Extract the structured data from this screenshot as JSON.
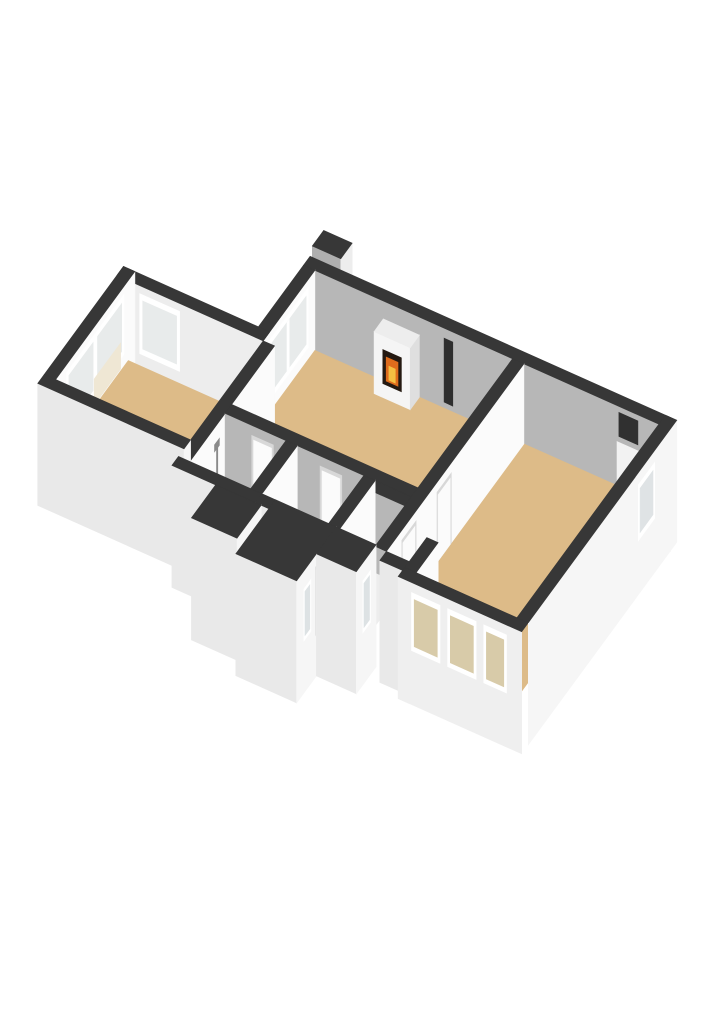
{
  "meta": {
    "image_type": "3d-floorplan-render",
    "background": "#FFFFFF",
    "view": "isometric-cutaway"
  },
  "palette": {
    "wall_top": "#373737",
    "wall_white_face": "#FBFBFB",
    "wall_gray_face": "#B7B7B7",
    "wall_ext_light": "#E9E9E9",
    "wall_ext_white": "#F6F6F6",
    "floor_tan": "#DDBB88",
    "floor_gold": "#D2A35C",
    "floor_blue": "#D4DFE8",
    "glass": "#E8EBEB",
    "glass_ext": "#D8CBA9",
    "frame_white": "#FFFFFF",
    "radiator_cream": "#EFE7D4",
    "firebox_dark": "#241911",
    "flame_orange": "#DF6C1C",
    "flame_yellow": "#F5BF42"
  },
  "rooms": [
    {
      "id": "bedroom-left",
      "floor": "#DDBB88"
    },
    {
      "id": "living-room",
      "floor": "#DDBB88"
    },
    {
      "id": "bedroom-right",
      "floor": "#DDBB88"
    },
    {
      "id": "bathroom",
      "floor": "#D4DFE8"
    },
    {
      "id": "hallway",
      "floor": "#D2A35C"
    },
    {
      "id": "utility-room",
      "floor": "#EDEDED"
    },
    {
      "id": "balcony",
      "floor": "#D4DFE8"
    },
    {
      "id": "window-bay",
      "floor": "#DDBB88"
    }
  ],
  "scene": {
    "projection": {
      "ox": 180,
      "oy": 290,
      "ax": 38,
      "ay": 17,
      "bx": -22,
      "by": 30
    },
    "wall_height": 80,
    "elements": [
      {
        "name": "chimney",
        "kind": "box",
        "x1": 3.55,
        "y1": -0.4,
        "x2": 4.3,
        "y2": 0.12,
        "h": 108,
        "b": -42,
        "fills": {
          "top": "#373737",
          "x": "#EDEDED",
          "y": "#AFAFAF"
        }
      },
      {
        "name": "facade-top-wall",
        "kind": "box",
        "x1": 3.25,
        "y1": -0.3,
        "x2": 12.9,
        "y2": 0,
        "h": 80,
        "b": -42,
        "fills": {
          "top": "#373737",
          "y": "#B7B7B7"
        }
      },
      {
        "name": "vent-niche",
        "kind": "decaly",
        "y": 0,
        "u1": 6.95,
        "u2": 7.18,
        "z1": 6,
        "z2": 70,
        "fill": "#2E2E2E"
      },
      {
        "name": "radiator-right",
        "kind": "decaly",
        "y": 0,
        "u1": 11.5,
        "u2": 12.1,
        "z1": 2,
        "z2": 44,
        "fill": "#F2F2F2"
      },
      {
        "name": "niche-right",
        "kind": "decaly",
        "y": 0,
        "u1": 11.55,
        "u2": 12.05,
        "z1": 50,
        "z2": 74,
        "fill": "#303030"
      },
      {
        "name": "living-window-wall",
        "kind": "box",
        "x1": 3.25,
        "y1": 0,
        "x2": 3.55,
        "y2": 2.35,
        "h": 80,
        "b": -42,
        "fills": {
          "top": "#373737",
          "x": "#FBFBFB",
          "y": "#E9E9E9"
        }
      },
      {
        "name": "living-window-frame",
        "kind": "decalx",
        "x": 3.55,
        "u1": 0.3,
        "u2": 2.15,
        "z1": 12,
        "z2": 72,
        "fill": "#FFFFFF"
      },
      {
        "name": "living-window-glass",
        "kind": "decalx",
        "x": 3.55,
        "u1": 0.4,
        "u2": 2.05,
        "z1": 18,
        "z2": 66,
        "fill": "#E8EBEB"
      },
      {
        "name": "living-window-mullion",
        "kind": "decalx",
        "x": 3.55,
        "u1": 1.17,
        "u2": 1.27,
        "z1": 18,
        "z2": 66,
        "fill": "#FFFFFF"
      },
      {
        "name": "bedroom-top-wall",
        "kind": "box",
        "x1": -0.3,
        "y1": 2.05,
        "x2": 3.55,
        "y2": 2.35,
        "h": 80,
        "b": -42,
        "fills": {
          "top": "#373737",
          "y": "#EDEDED"
        }
      },
      {
        "name": "bedroom-corner-window-frame",
        "kind": "decaly",
        "y": 2.35,
        "u1": 0.3,
        "u2": 1.35,
        "z1": 12,
        "z2": 72,
        "fill": "#FFFFFF"
      },
      {
        "name": "bedroom-corner-window-glass",
        "kind": "decaly",
        "y": 2.35,
        "u1": 0.38,
        "u2": 1.27,
        "z1": 18,
        "z2": 66,
        "fill": "#E8EBEB"
      },
      {
        "name": "bedroom-window-wall",
        "kind": "box",
        "x1": -0.3,
        "y1": 2.05,
        "x2": 0,
        "y2": 5.65,
        "h": 80,
        "b": -42,
        "fills": {
          "top": "#373737",
          "x": "#FBFBFB"
        }
      },
      {
        "name": "bedroom-window-frame",
        "kind": "decalx",
        "x": 0,
        "u1": 2.55,
        "u2": 5.15,
        "z1": 12,
        "z2": 72,
        "fill": "#FFFFFF"
      },
      {
        "name": "bedroom-window-glass-1",
        "kind": "decalx",
        "x": 0,
        "u1": 2.65,
        "u2": 3.75,
        "z1": 18,
        "z2": 66,
        "fill": "#E8EBEB"
      },
      {
        "name": "bedroom-window-glass-2",
        "kind": "decalx",
        "x": 0,
        "u1": 3.95,
        "u2": 5.05,
        "z1": 18,
        "z2": 66,
        "fill": "#E8EBEB"
      },
      {
        "name": "bedroom-radiator-panel",
        "kind": "decalx",
        "x": 0,
        "u1": 2.7,
        "u2": 3.9,
        "z1": 2,
        "z2": 28,
        "fill": "#EFE7D4"
      },
      {
        "name": "living-room-floor",
        "kind": "floor",
        "pts": [
          [
            3.55,
            0
          ],
          [
            8.75,
            0
          ],
          [
            8.75,
            4.3
          ],
          [
            3.55,
            4.3
          ]
        ],
        "fill": "#DDBB88"
      },
      {
        "name": "bedroom-left-floor",
        "kind": "floor",
        "pts": [
          [
            0,
            2.35
          ],
          [
            3.55,
            2.35
          ],
          [
            3.55,
            5.65
          ],
          [
            0,
            5.65
          ]
        ],
        "fill": "#DDBB88"
      },
      {
        "name": "bedroom-right-floor",
        "kind": "floor",
        "pts": [
          [
            9.05,
            0
          ],
          [
            12.6,
            0
          ],
          [
            12.6,
            5.45
          ],
          [
            9.05,
            5.45
          ]
        ],
        "fill": "#DDBB88"
      },
      {
        "name": "bay-floor",
        "kind": "floor",
        "pts": [
          [
            9.95,
            5.45
          ],
          [
            12.6,
            5.45
          ],
          [
            12.6,
            6.45
          ],
          [
            9.95,
            6.45
          ]
        ],
        "fill": "#DDBB88"
      },
      {
        "name": "balcony-threshold",
        "kind": "floor",
        "pts": [
          [
            9.05,
            5.3
          ],
          [
            9.65,
            5.3
          ],
          [
            9.65,
            5.45
          ],
          [
            9.05,
            5.45
          ]
        ],
        "fill": "#F0F0F0"
      },
      {
        "name": "balcony-floor",
        "kind": "floor",
        "pts": [
          [
            9.05,
            5.45
          ],
          [
            9.65,
            5.45
          ],
          [
            9.65,
            6.25
          ],
          [
            9.05,
            6.25
          ]
        ],
        "fill": "#D4DFE8"
      },
      {
        "name": "bathroom-floor",
        "kind": "floor",
        "pts": [
          [
            3.85,
            4.6
          ],
          [
            5.45,
            4.6
          ],
          [
            5.45,
            6.2
          ],
          [
            3.85,
            6.2
          ]
        ],
        "fill": "#D4DFE8"
      },
      {
        "name": "hallway-floor",
        "kind": "floor",
        "pts": [
          [
            5.75,
            4.6
          ],
          [
            7.5,
            4.6
          ],
          [
            7.5,
            6.2
          ],
          [
            5.75,
            6.2
          ]
        ],
        "fill": "#D2A35C"
      },
      {
        "name": "utility-floor",
        "kind": "floor",
        "pts": [
          [
            7.8,
            4.9
          ],
          [
            8.75,
            4.9
          ],
          [
            8.75,
            6.2
          ],
          [
            7.8,
            6.2
          ]
        ],
        "fill": "#EDEDED"
      },
      {
        "name": "fireplace-surround",
        "kind": "box",
        "x1": 5.35,
        "y1": 0,
        "x2": 6.3,
        "y2": 0.42,
        "h": 62,
        "b": 0,
        "fills": {
          "top": "#EDEDED",
          "x": "#DFDFDF",
          "y": "#F5F5F5"
        }
      },
      {
        "name": "fireplace-firebox",
        "kind": "decaly",
        "y": 0.42,
        "u1": 5.58,
        "u2": 6.07,
        "z1": 14,
        "z2": 48,
        "fill": "#241911"
      },
      {
        "name": "fireplace-flame",
        "kind": "decaly",
        "y": 0.42,
        "u1": 5.67,
        "u2": 5.98,
        "z1": 18,
        "z2": 42,
        "fill": "#DF6C1C"
      },
      {
        "name": "fireplace-flame-core",
        "kind": "decaly",
        "y": 0.42,
        "u1": 5.74,
        "u2": 5.91,
        "z1": 20,
        "z2": 34,
        "fill": "#F5BF42"
      },
      {
        "name": "bedroom-bathroom-divider",
        "kind": "box",
        "x1": 3.55,
        "y1": 2.35,
        "x2": 3.85,
        "y2": 6.5,
        "h": 80,
        "b": 0,
        "fills": {
          "top": "#373737",
          "x": "#FBFBFB"
        }
      },
      {
        "name": "shower-pole",
        "kind": "decalx",
        "x": 3.85,
        "u1": 4.93,
        "u2": 4.99,
        "z1": 28,
        "z2": 58,
        "fill": "#8A8A8A"
      },
      {
        "name": "shower-head",
        "kind": "decalx",
        "x": 3.85,
        "u1": 4.86,
        "u2": 5.08,
        "z1": 56,
        "z2": 63,
        "fill": "#8A8A8A"
      },
      {
        "name": "toilet-tank",
        "kind": "box",
        "x1": 3.9,
        "y1": 5.78,
        "x2": 4.2,
        "y2": 5.96,
        "h": 30,
        "b": 0,
        "fills": {
          "top": "#F0F0F0",
          "x": "#E6E6E6",
          "y": "#FAFAFA"
        }
      },
      {
        "name": "toilet-bowl",
        "kind": "box",
        "x1": 3.93,
        "y1": 5.48,
        "x2": 4.17,
        "y2": 5.8,
        "h": 16,
        "b": 0,
        "fills": {
          "top": "#FFFFFF",
          "x": "#E8E8E8",
          "y": "#F6F6F6"
        }
      },
      {
        "name": "living-bottom-wall",
        "kind": "box",
        "x1": 3.85,
        "y1": 4.3,
        "x2": 8.75,
        "y2": 4.6,
        "h": 80,
        "b": 0,
        "fills": {
          "top": "#373737",
          "y": "#B7B7B7"
        }
      },
      {
        "name": "bathroom-door-frame",
        "kind": "decaly",
        "y": 4.6,
        "u1": 4.55,
        "u2": 5.12,
        "z1": 0,
        "z2": 70,
        "fill": "#D8D8D8"
      },
      {
        "name": "bathroom-door",
        "kind": "decaly",
        "y": 4.6,
        "u1": 4.6,
        "u2": 5.07,
        "z1": 0,
        "z2": 66,
        "fill": "#FBFBFB"
      },
      {
        "name": "living-door-frame",
        "kind": "decaly",
        "y": 4.6,
        "u1": 6.35,
        "u2": 6.92,
        "z1": 0,
        "z2": 70,
        "fill": "#D8D8D8"
      },
      {
        "name": "living-door",
        "kind": "decaly",
        "y": 4.6,
        "u1": 6.4,
        "u2": 6.87,
        "z1": 0,
        "z2": 66,
        "fill": "#FBFBFB"
      },
      {
        "name": "hall-bathroom-divider",
        "kind": "box",
        "x1": 5.45,
        "y1": 4.6,
        "x2": 5.75,
        "y2": 6.5,
        "h": 80,
        "b": 0,
        "fills": {
          "top": "#373737",
          "x": "#FBFBFB"
        }
      },
      {
        "name": "utility-top-wall",
        "kind": "box",
        "x1": 7.8,
        "y1": 4.6,
        "x2": 8.75,
        "y2": 4.9,
        "h": 80,
        "b": 0,
        "fills": {
          "top": "#373737",
          "y": "#B7B7B7"
        }
      },
      {
        "name": "hall-utility-divider",
        "kind": "box",
        "x1": 7.5,
        "y1": 4.6,
        "x2": 7.8,
        "y2": 6.5,
        "h": 80,
        "b": 0,
        "fills": {
          "top": "#373737",
          "x": "#FBFBFB"
        }
      },
      {
        "name": "utility-appliance",
        "kind": "box",
        "x1": 8.0,
        "y1": 5.85,
        "x2": 8.3,
        "y2": 6.18,
        "h": 26,
        "b": 0,
        "fills": {
          "top": "#3E3E3E",
          "x": "#E9E9E9",
          "y": "#F4F4F4"
        }
      },
      {
        "name": "living-right-divider",
        "kind": "box",
        "x1": 8.75,
        "y1": 0,
        "x2": 9.05,
        "y2": 6.25,
        "h": 80,
        "b": 0,
        "fills": {
          "top": "#373737",
          "x": "#FBFBFB"
        }
      },
      {
        "name": "right-door-frame-1",
        "kind": "decalx",
        "x": 9.05,
        "u1": 3.3,
        "u2": 3.95,
        "z1": 0,
        "z2": 70,
        "fill": "#D8D8D8"
      },
      {
        "name": "right-door-1",
        "kind": "decalx",
        "x": 9.05,
        "u1": 3.35,
        "u2": 3.9,
        "z1": 0,
        "z2": 66,
        "fill": "#FBFBFB"
      },
      {
        "name": "right-door-frame-2",
        "kind": "decalx",
        "x": 9.05,
        "u1": 4.9,
        "u2": 5.55,
        "z1": 0,
        "z2": 70,
        "fill": "#D8D8D8"
      },
      {
        "name": "right-door-2",
        "kind": "decalx",
        "x": 9.05,
        "u1": 4.95,
        "u2": 5.5,
        "z1": 0,
        "z2": 66,
        "fill": "#FBFBFB"
      },
      {
        "name": "bedroom-bottom-wall",
        "kind": "box",
        "x1": -0.3,
        "y1": 5.65,
        "x2": 3.55,
        "y2": 5.95,
        "h": 80,
        "b": -42,
        "fills": {
          "top": "#373737",
          "y": "#E9E9E9",
          "x": "#F6F6F6"
        }
      },
      {
        "name": "bathroom-bottom-wall",
        "kind": "box",
        "x1": 3.55,
        "y1": 6.2,
        "x2": 5.75,
        "y2": 6.5,
        "h": 80,
        "b": -42,
        "fills": {
          "top": "#373737",
          "y": "#E9E9E9",
          "x": "#F6F6F6"
        }
      },
      {
        "name": "hall-bottom-wall",
        "kind": "box",
        "x1": 5.75,
        "y1": 6.2,
        "x2": 6.1,
        "y2": 6.5,
        "h": 80,
        "b": -42,
        "fills": {
          "top": "#373737",
          "y": "#E9E9E9"
        }
      },
      {
        "name": "storage-block",
        "kind": "box",
        "x1": 4.7,
        "y1": 6.5,
        "x2": 5.9,
        "y2": 7.6,
        "h": 80,
        "b": -42,
        "fills": {
          "top": "#373737",
          "x": "#F6F6F6",
          "y": "#E9E9E9"
        }
      },
      {
        "name": "entrance-block",
        "kind": "box",
        "x1": 6.1,
        "y1": 6.2,
        "x2": 7.7,
        "y2": 8.0,
        "h": 80,
        "b": -42,
        "fills": {
          "top": "#373737",
          "x": "#F6F6F6",
          "y": "#E9E9E9"
        }
      },
      {
        "name": "entrance-door-frame",
        "kind": "decalx",
        "x": 7.7,
        "u1": 6.5,
        "u2": 7.15,
        "z1": 0,
        "z2": 68,
        "fill": "#E4E4E4"
      },
      {
        "name": "entrance-door",
        "kind": "decalx",
        "x": 7.7,
        "u1": 6.54,
        "u2": 7.11,
        "z1": 0,
        "z2": 64,
        "fill": "#FAFAFA"
      },
      {
        "name": "entrance-window-frame",
        "kind": "decalx",
        "x": 7.7,
        "u1": 7.35,
        "u2": 7.67,
        "z1": 10,
        "z2": 62,
        "fill": "#FFFFFF"
      },
      {
        "name": "entrance-window-glass",
        "kind": "decalx",
        "x": 7.7,
        "u1": 7.4,
        "u2": 7.62,
        "z1": 14,
        "z2": 58,
        "fill": "#DDE2E4"
      },
      {
        "name": "side-block",
        "kind": "box",
        "x1": 7.7,
        "y1": 6.2,
        "x2": 8.75,
        "y2": 7.1,
        "h": 80,
        "b": -42,
        "fills": {
          "top": "#373737",
          "x": "#F6F6F6",
          "y": "#E9E9E9"
        }
      },
      {
        "name": "side-window-frame",
        "kind": "decalx",
        "x": 8.75,
        "u1": 6.45,
        "u2": 6.8,
        "z1": 10,
        "z2": 62,
        "fill": "#FFFFFF"
      },
      {
        "name": "side-window-glass",
        "kind": "decalx",
        "x": 8.75,
        "u1": 6.5,
        "u2": 6.75,
        "z1": 14,
        "z2": 58,
        "fill": "#DDE2E4"
      },
      {
        "name": "balcony-bottom-wall",
        "kind": "box",
        "x1": 9.05,
        "y1": 6.25,
        "x2": 9.65,
        "y2": 6.55,
        "h": 80,
        "b": -42,
        "fills": {
          "top": "#373737",
          "y": "#E9E9E9",
          "x": "#F6F6F6"
        }
      },
      {
        "name": "bay-left-wall",
        "kind": "box",
        "x1": 9.65,
        "y1": 5.45,
        "x2": 9.95,
        "y2": 6.75,
        "h": 80,
        "b": -42,
        "fills": {
          "top": "#373737",
          "x": "#FBFBFB",
          "y": "#E9E9E9"
        }
      },
      {
        "name": "bay-bottom-wall",
        "kind": "box",
        "x1": 9.65,
        "y1": 6.45,
        "x2": 12.9,
        "y2": 6.75,
        "h": 80,
        "b": -42,
        "fills": {
          "top": "#373737",
          "y": "#EFEFEF"
        }
      },
      {
        "name": "bay-window-frame-1",
        "kind": "decaly",
        "y": 6.75,
        "u1": 10.0,
        "u2": 10.75,
        "z1": 12,
        "z2": 70,
        "fill": "#FFFFFF"
      },
      {
        "name": "bay-window-glass-1",
        "kind": "decaly",
        "y": 6.75,
        "u1": 10.07,
        "u2": 10.68,
        "z1": 17,
        "z2": 64,
        "fill": "#D8CBA9"
      },
      {
        "name": "bay-window-frame-2",
        "kind": "decaly",
        "y": 6.75,
        "u1": 10.95,
        "u2": 11.7,
        "z1": 12,
        "z2": 70,
        "fill": "#FFFFFF"
      },
      {
        "name": "bay-window-glass-2",
        "kind": "decaly",
        "y": 6.75,
        "u1": 11.02,
        "u2": 11.63,
        "z1": 17,
        "z2": 64,
        "fill": "#D8CBA9"
      },
      {
        "name": "bay-window-frame-3",
        "kind": "decaly",
        "y": 6.75,
        "u1": 11.9,
        "u2": 12.5,
        "z1": 12,
        "z2": 70,
        "fill": "#FFFFFF"
      },
      {
        "name": "bay-window-glass-3",
        "kind": "decaly",
        "y": 6.75,
        "u1": 11.97,
        "u2": 12.43,
        "z1": 17,
        "z2": 64,
        "fill": "#D8CBA9"
      },
      {
        "name": "end-wall",
        "kind": "box",
        "x1": 12.6,
        "y1": -0.3,
        "x2": 12.9,
        "y2": 6.45,
        "h": 80,
        "b": -42,
        "fills": {
          "top": "#373737",
          "x": "#F6F6F6"
        }
      },
      {
        "name": "end-window-frame",
        "kind": "decalx",
        "x": 12.9,
        "u1": 0.7,
        "u2": 1.45,
        "z1": 12,
        "z2": 68,
        "fill": "#FFFFFF"
      },
      {
        "name": "end-window-glass",
        "kind": "decalx",
        "x": 12.9,
        "u1": 0.78,
        "u2": 1.37,
        "z1": 18,
        "z2": 62,
        "fill": "#DFE3E5"
      }
    ]
  }
}
